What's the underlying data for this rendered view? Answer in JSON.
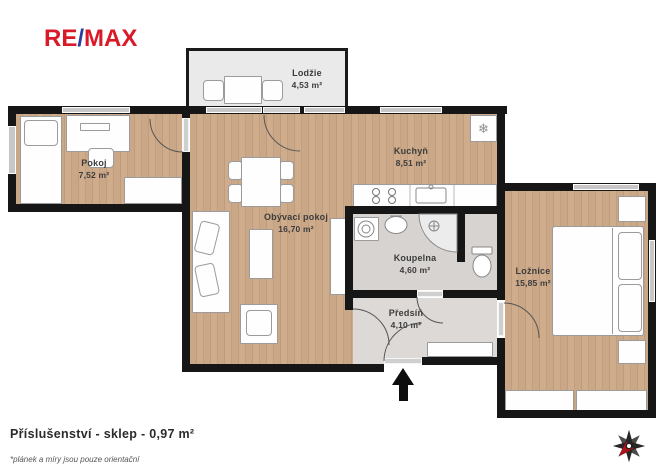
{
  "logo": {
    "part1": "RE",
    "slash": "/",
    "part2": "MAX"
  },
  "rooms": [
    {
      "id": "lodzie",
      "name": "Lodžie",
      "area": "4,53 m²"
    },
    {
      "id": "pokoj",
      "name": "Pokoj",
      "area": "7,52 m²"
    },
    {
      "id": "kuchyn",
      "name": "Kuchyň",
      "area": "8,51 m²"
    },
    {
      "id": "obyvaci-pokoj",
      "name": "Obývací pokoj",
      "area": "16,70 m²"
    },
    {
      "id": "koupelna",
      "name": "Koupelna",
      "area": "4,60 m²"
    },
    {
      "id": "predsin",
      "name": "Předsíň",
      "area": "4,10 m²"
    },
    {
      "id": "loznice",
      "name": "Ložnice",
      "area": "15,85 m²"
    }
  ],
  "footer": {
    "accessories": "Příslušenství - sklep - 0,97 m²",
    "disclaimer": "*plánek a míry jsou pouze orientační"
  },
  "icons": {
    "fridge": "❄"
  },
  "colors": {
    "logo_red": "#da1a28",
    "logo_blue": "#2a3f9d",
    "wall": "#161616",
    "wood_floor": "#c9a787",
    "bath_floor": "#d7d3d0",
    "hall_floor": "#dcd9d6",
    "balcony_floor": "#eaeaea",
    "compass_needle": "#b01116"
  }
}
